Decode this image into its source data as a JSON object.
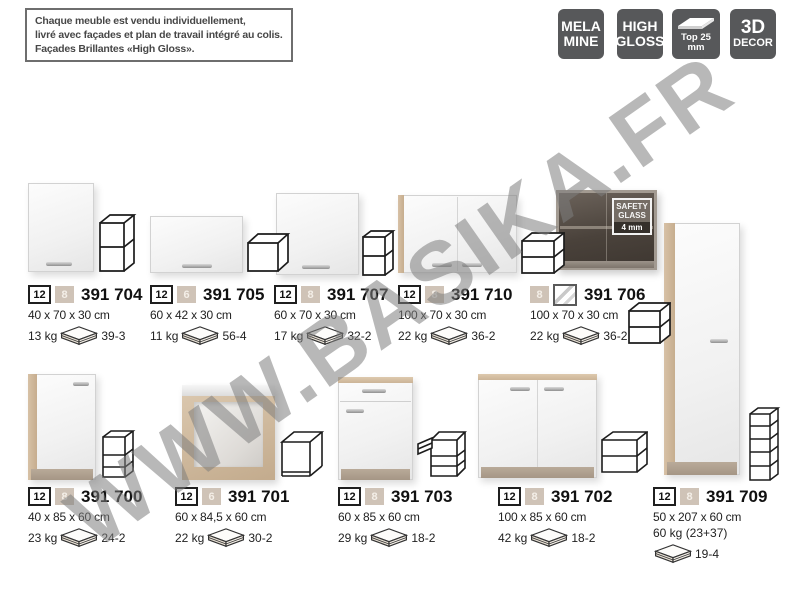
{
  "info_box": {
    "line1": "Chaque meuble est vendu individuellement,",
    "line2": "livré avec façades et plan de travail intégré au colis.",
    "line3": "Façades Brillantes «High Gloss»."
  },
  "feature_badges": {
    "melamine": {
      "line1": "MELA",
      "line2": "MINE"
    },
    "high_gloss": {
      "line1": "HIGH",
      "line2": "GLOSS"
    },
    "top": {
      "caption": "Top 25 mm"
    },
    "decor": {
      "line1": "3D",
      "line2": "DECOR"
    }
  },
  "watermark": {
    "text": "WWW.BASIKA.FR"
  },
  "safety_glass": {
    "line1": "SAFETY",
    "line2": "GLASS",
    "line3": "4 mm"
  },
  "products": [
    {
      "code": "391 704",
      "qty": "12",
      "badge": "8",
      "dims": "40 x 70 x 30 cm",
      "weight": "13 kg",
      "ref": "39-3"
    },
    {
      "code": "391 705",
      "qty": "12",
      "badge": "6",
      "dims": "60 x 42 x 30 cm",
      "weight": "11 kg",
      "ref": "56-4"
    },
    {
      "code": "391 707",
      "qty": "12",
      "badge": "8",
      "dims": "60 x 70 x 30 cm",
      "weight": "17 kg",
      "ref": "32-2"
    },
    {
      "code": "391 710",
      "qty": "12",
      "badge": "8",
      "dims": "100 x 70 x 30 cm",
      "weight": "22 kg",
      "ref": "36-2"
    },
    {
      "code": "391 706",
      "badge": "8",
      "dims": "100 x 70 x 30 cm",
      "weight": "22 kg",
      "ref": "36-2"
    },
    {
      "code": "391 700",
      "qty": "12",
      "badge": "8",
      "dims": "40 x 85 x 60 cm",
      "weight": "23 kg",
      "ref": "24-2"
    },
    {
      "code": "391 701",
      "qty": "12",
      "badge": "6",
      "dims": "60 x 84,5 x 60 cm",
      "weight": "22 kg",
      "ref": "30-2"
    },
    {
      "code": "391 703",
      "qty": "12",
      "badge": "8",
      "dims": "60 x 85 x 60 cm",
      "weight": "29 kg",
      "ref": "18-2"
    },
    {
      "code": "391 702",
      "qty": "12",
      "badge": "8",
      "dims": "100 x 85 x 60 cm",
      "weight": "42 kg",
      "ref": "18-2"
    },
    {
      "code": "391 709",
      "qty": "12",
      "badge": "8",
      "dims": "50 x 207 x 60 cm",
      "weight": "60 kg (23+37)",
      "ref": "19-4"
    }
  ]
}
